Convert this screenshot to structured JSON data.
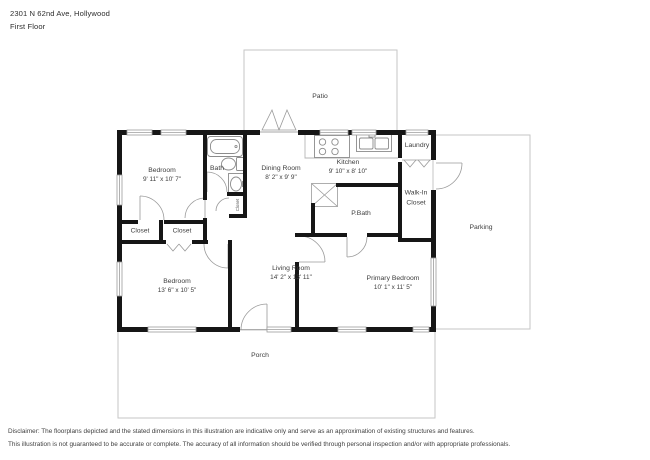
{
  "header": {
    "address": "2301 N 62nd Ave, Hollywood",
    "floor_label": "First Floor"
  },
  "outdoor_areas": {
    "patio": "Patio",
    "parking": "Parking",
    "porch": "Porch"
  },
  "rooms": {
    "bedroom1": {
      "name": "Bedroom",
      "dims": "9' 11\" x 10' 7\""
    },
    "bath": {
      "name": "Bath"
    },
    "dining_room": {
      "name": "Dining Room",
      "dims": "8' 2\" x 9' 9\""
    },
    "kitchen": {
      "name": "Kitchen",
      "dims": "9' 10\" x 8' 10\""
    },
    "laundry": {
      "name": "Laundry"
    },
    "walk_in_closet": {
      "name_line1": "Walk-In",
      "name_line2": "Closet"
    },
    "primary_bath": {
      "name": "P.Bath"
    },
    "closet_left": {
      "name": "Closet"
    },
    "closet_right": {
      "name": "Closet"
    },
    "closet_hall": {
      "name": "Closet"
    },
    "bedroom2": {
      "name": "Bedroom",
      "dims": "13' 6\" x 10' 5\""
    },
    "living_room": {
      "name": "Living Room",
      "dims": "14' 2\" x 13' 11\""
    },
    "primary_bedroom": {
      "name": "Primary Bedroom",
      "dims": "10' 1\" x 11' 5\""
    }
  },
  "disclaimer": {
    "line1": "Disclaimer: The floorplans depicted and the stated dimensions in this illustration are indicative only and serve as an approximation of existing structures and features.",
    "line2": "This illustration is not guaranteed to be accurate or complete. The accuracy of all information should be verified through personal inspection and/or with appropriate professionals."
  },
  "colors": {
    "wall": "#161616",
    "outdoor_outline": "#c6c6c6",
    "fixture_line": "#8c8c8c",
    "text": "#3d3d3d"
  }
}
